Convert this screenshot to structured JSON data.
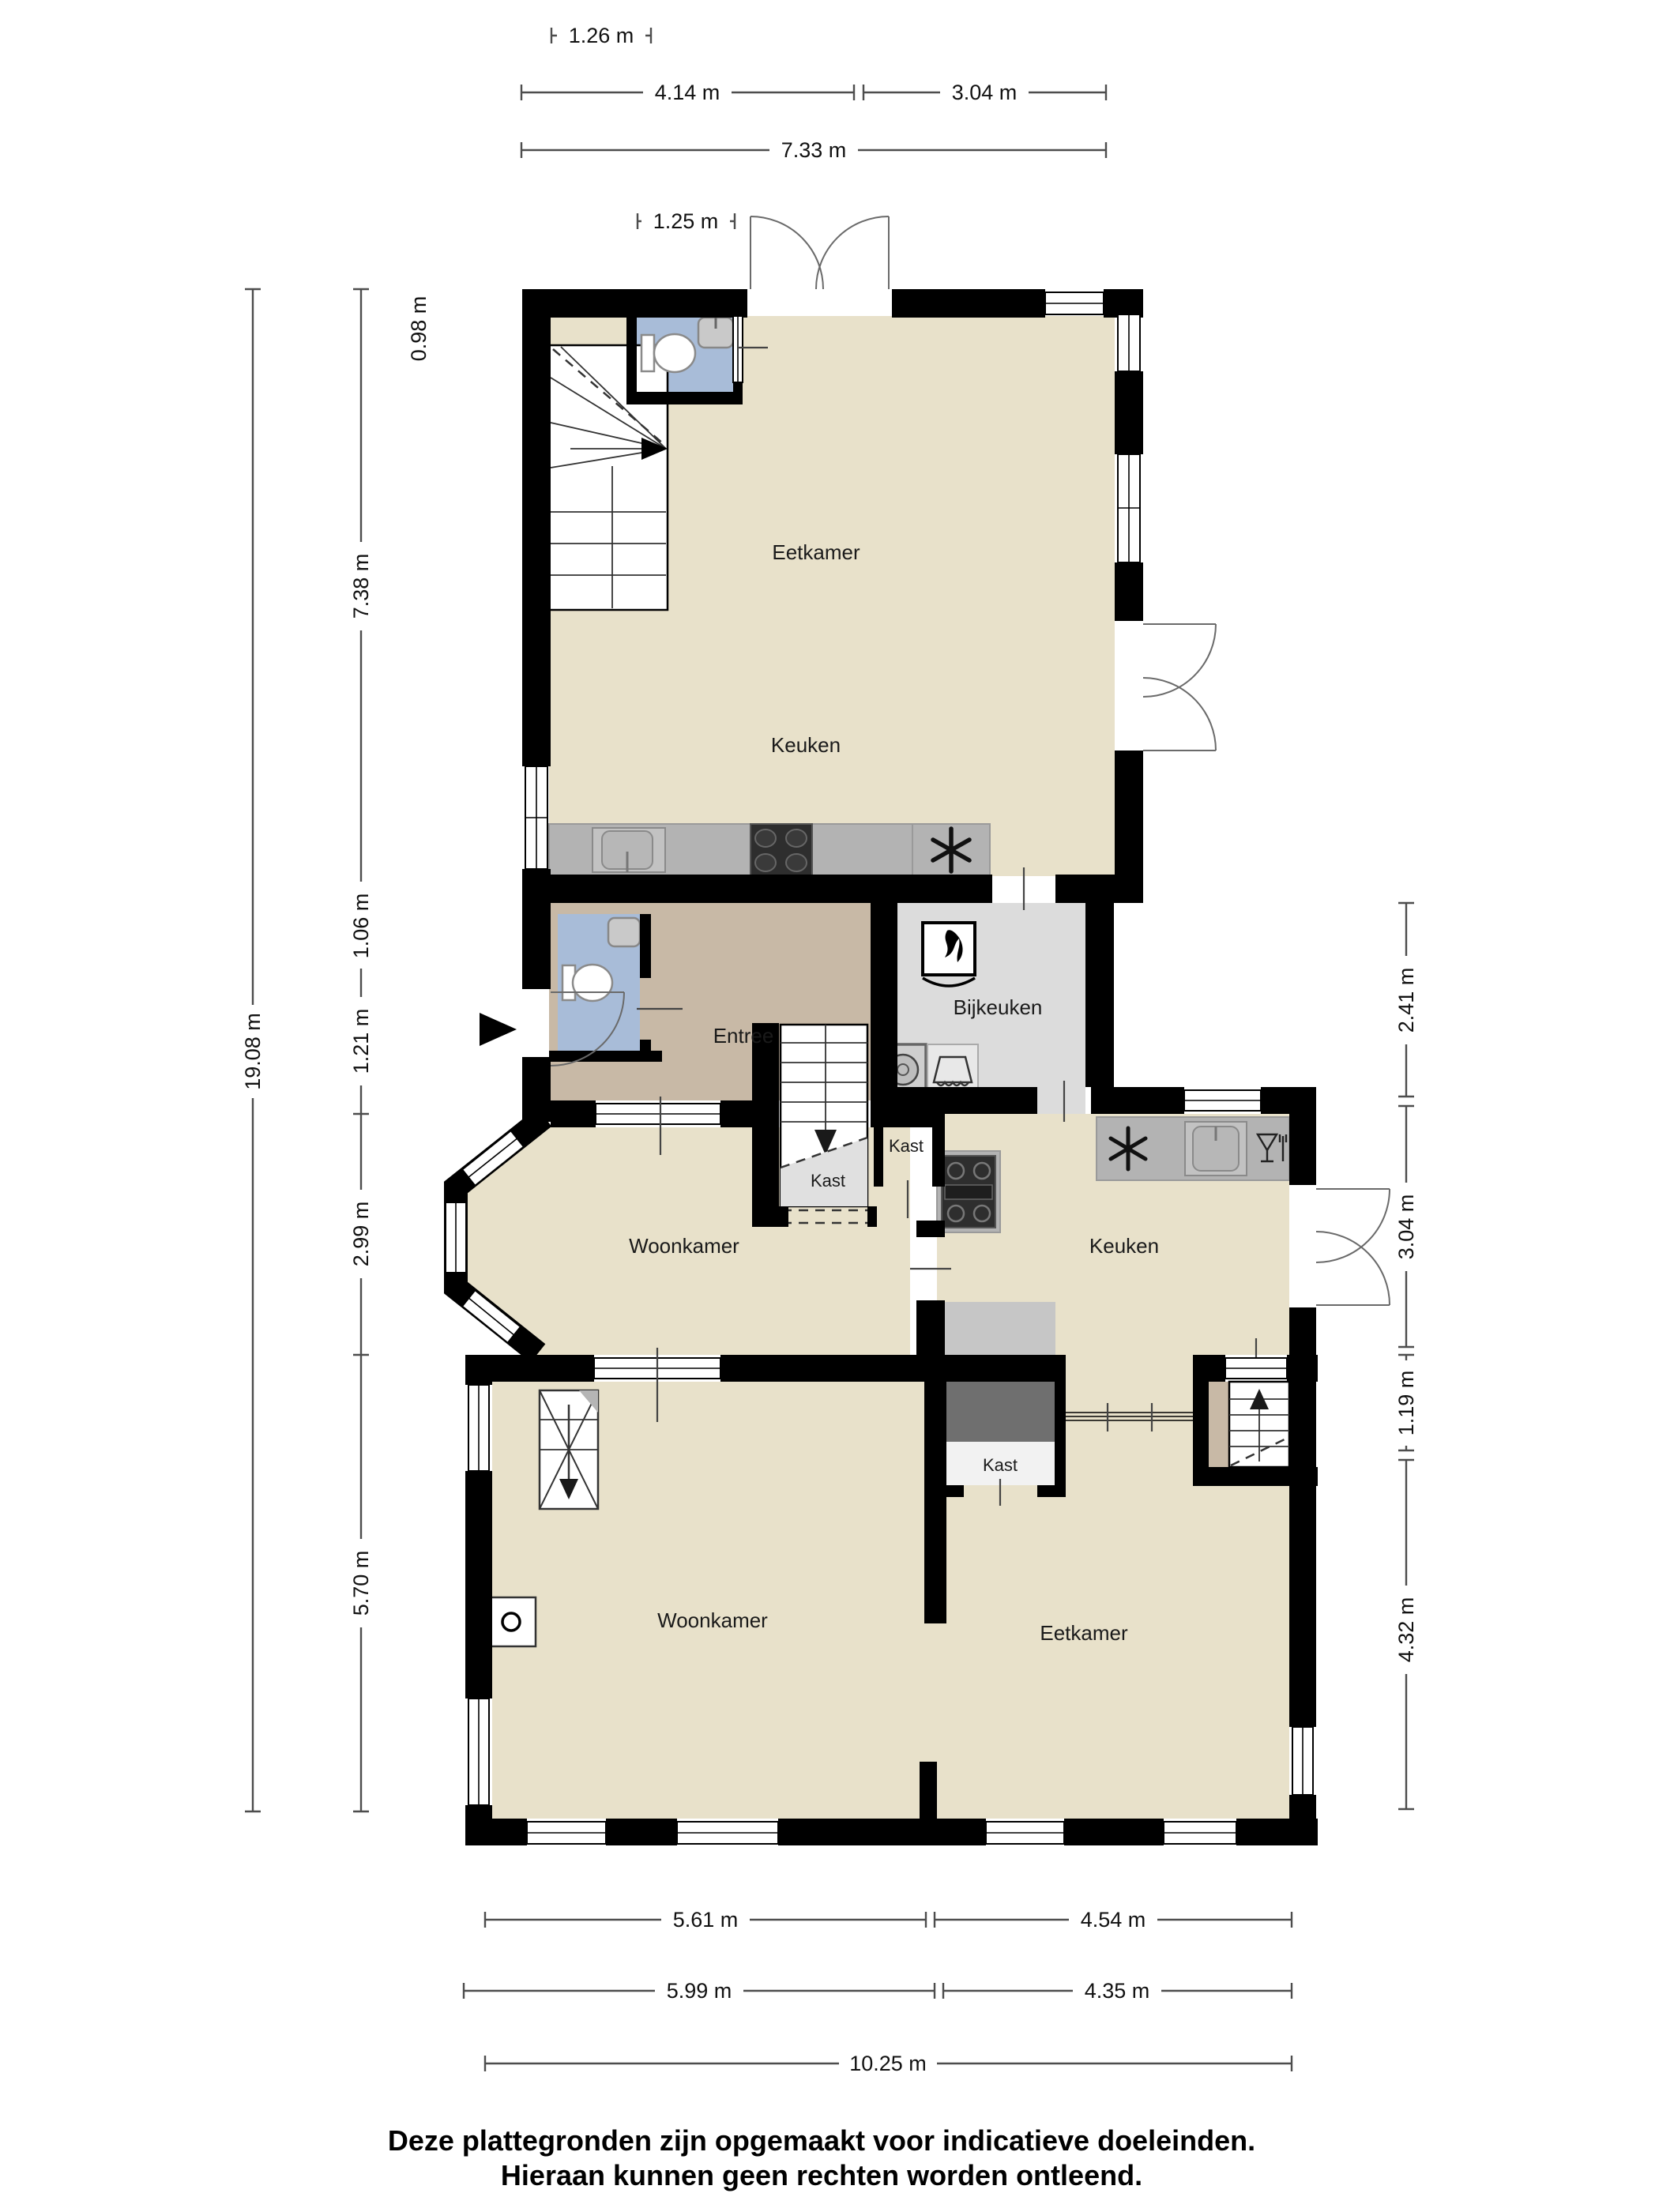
{
  "rooms": {
    "eetkamer_top": "Eetkamer",
    "keuken_top": "Keuken",
    "entree": "Entree",
    "bijkeuken": "Bijkeuken",
    "kast_trap": "Kast",
    "kast_hal": "Kast",
    "woonkamer_mid": "Woonkamer",
    "keuken_mid": "Keuken",
    "kast_eetkamer": "Kast",
    "woonkamer": "Woonkamer",
    "eetkamer": "Eetkamer"
  },
  "dims": {
    "t1": "1.26 m",
    "t2": "4.14 m",
    "t3": "3.04 m",
    "t4": "7.33 m",
    "t5": "1.25 m",
    "l1": "0.98 m",
    "l2": "7.38 m",
    "l3": "1.06 m",
    "l4": "1.21 m",
    "l5": "2.99 m",
    "l6": "5.70 m",
    "l7": "19.08 m",
    "r1": "2.41 m",
    "r2": "3.04 m",
    "r3": "1.19 m",
    "r4": "4.32 m",
    "b1": "5.61 m",
    "b2": "4.54 m",
    "b3": "5.99 m",
    "b4": "4.35 m",
    "b5": "10.25 m"
  },
  "disclaimer": {
    "line1": "Deze plattegronden zijn opgemaakt voor indicatieve doeleinden.",
    "line2": "Hieraan kunnen geen rechten worden ontleend."
  },
  "colors": {
    "walls": "#000000",
    "floor_main": "#e8e1ca",
    "floor_entree": "#c8b9a6",
    "floor_toilet": "#a8bcd8",
    "floor_utility": "#dcdcdc",
    "counter_gray": "#b3b3b3",
    "appliance_dark": "#2e2e2e",
    "closet_dark": "#6f6f6f"
  },
  "icons": {
    "refrigerator": "asterisk-snowflake",
    "cooktop": "four-burner-stove",
    "kitchen_sink": "square-basin-with-faucet",
    "toilet": "cistern-and-bowl",
    "washbasin": "wall-basin",
    "boiler": "flame-in-box",
    "washing_machine": "square-with-drum-circle",
    "dryer": "square-with-laundry-glyph",
    "dishwasher": "wine-glass-and-fork",
    "fireplace": "square-with-circle",
    "entrance_marker": "solid-right-arrow",
    "stairs_up": "treads-with-up-arrow",
    "stairs_down": "treads-with-down-arrow",
    "skylight": "rect-with-cross-and-arrow"
  }
}
